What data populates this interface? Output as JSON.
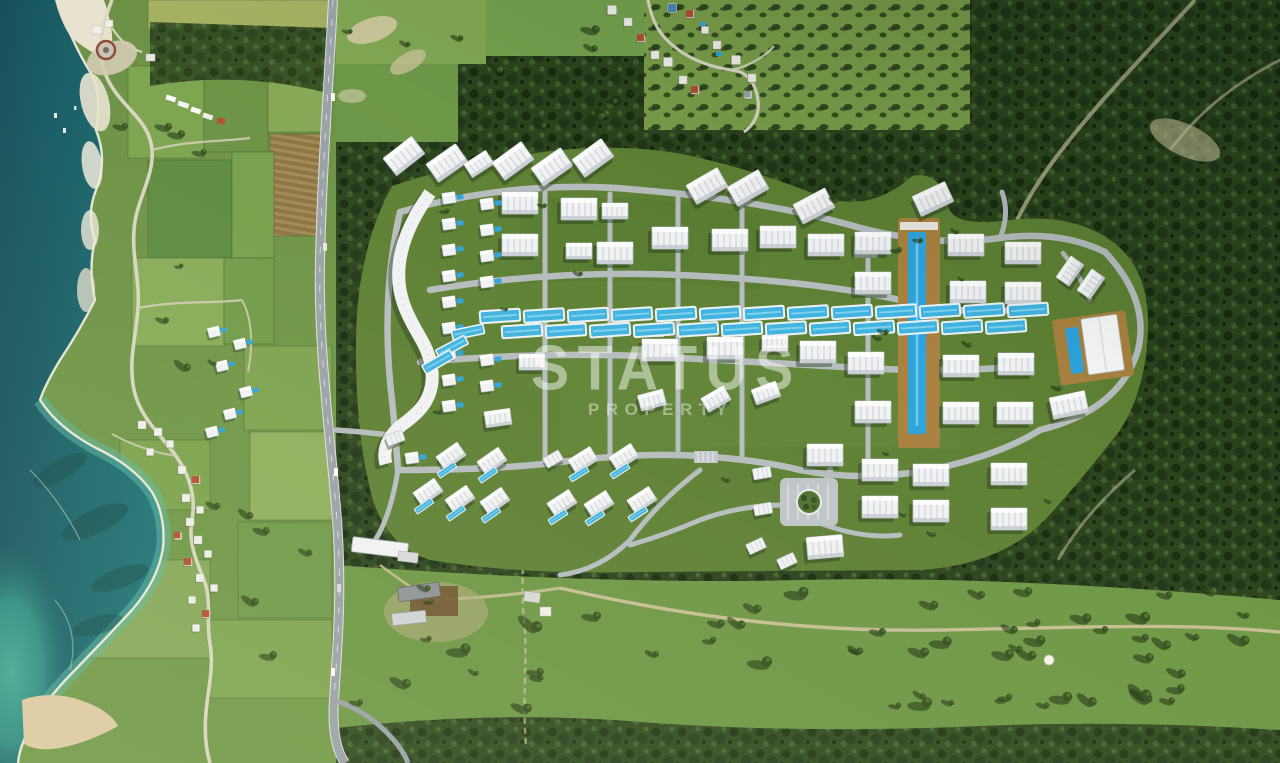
{
  "watermark": {
    "brand": "STATUS",
    "tagline": "PROPERTY"
  },
  "palette": {
    "sea_deep": "#14525e",
    "sea_mid": "#1b6e72",
    "sea_bay": "#2f9183",
    "sea_shallow": "#5ab8a2",
    "surf": "#f4f0e4",
    "cliff": "#e9e2cf",
    "sand": "#dbc9a3",
    "field_light": "#8aab56",
    "field_mid": "#6f9a47",
    "field_dark": "#5d8a3f",
    "plow_brown": "#8c7342",
    "grove": "#7da24c",
    "forest": "#2a431d",
    "forest_dark": "#182c10",
    "meadow": "#6d9745",
    "lawn": "#5d8034",
    "road_gray": "#b9bec3",
    "highway": "#9aa1a7",
    "dirt": "#cfc19b",
    "building_white": "#f1f2f4",
    "building_shade": "#c7cbd0",
    "pool_blue": "#2fa3dc",
    "pool_teal": "#3fb3e0",
    "deck_brown": "#a8813f",
    "roof_red": "#b14f30",
    "watermark_color": "rgba(255,255,255,0.48)",
    "watermark_color_sub": "rgba(255,255,255,0.42)"
  }
}
